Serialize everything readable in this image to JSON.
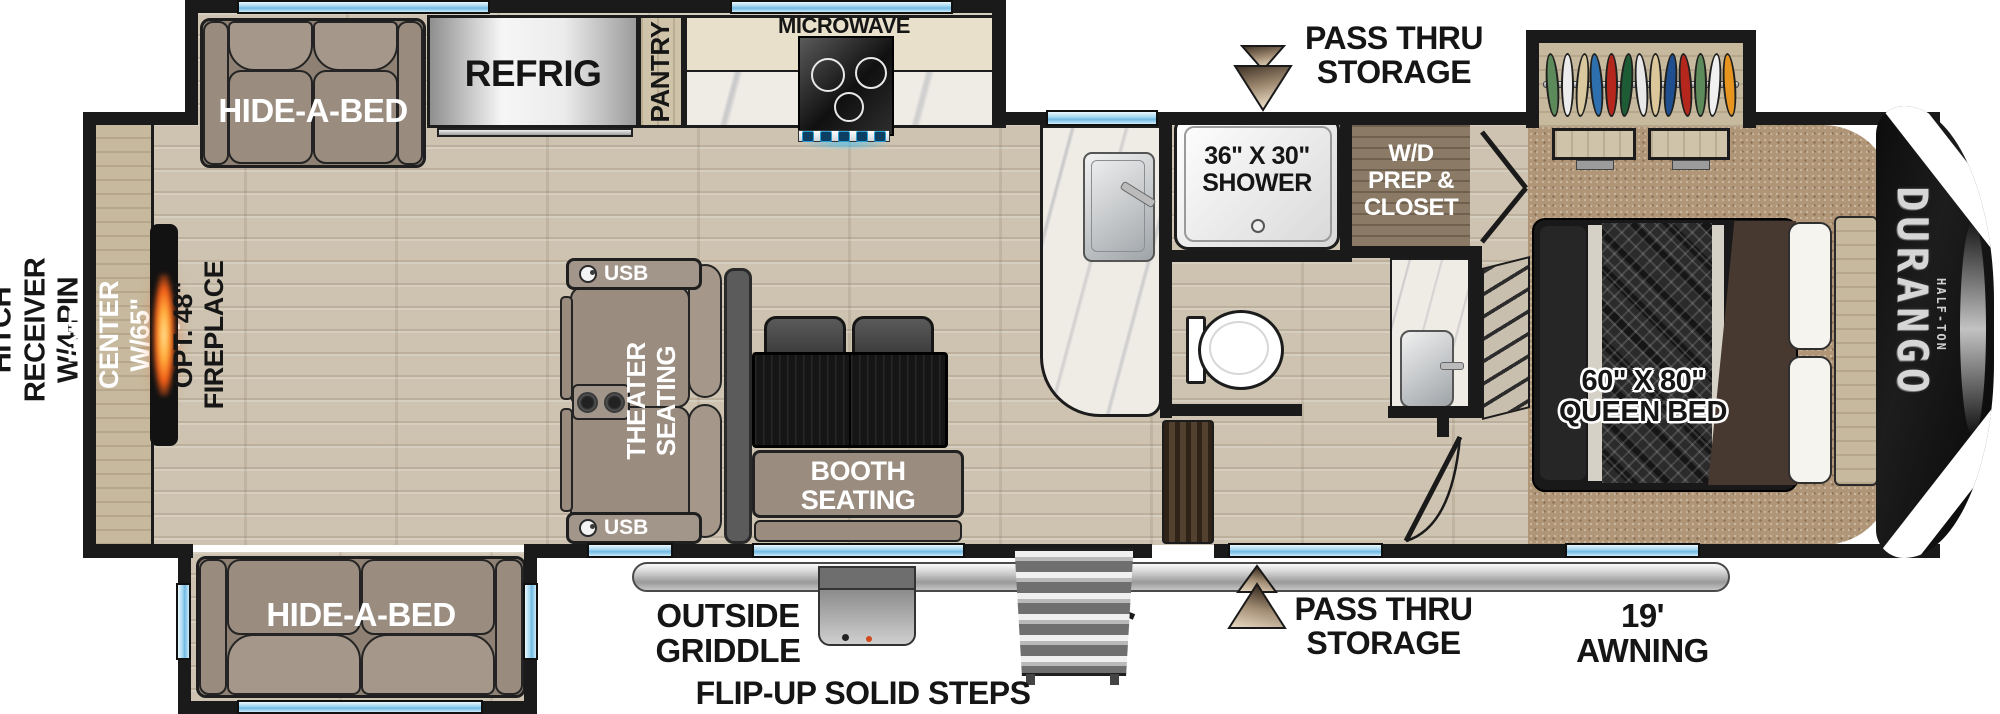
{
  "exterior": {
    "hitch_label": "STD. HITCH RECEIVER\nW/4-PIN HARNESS",
    "pass_thru_top": "PASS THRU\nSTORAGE",
    "pass_thru_bottom": "PASS THRU\nSTORAGE",
    "outside_griddle": "OUTSIDE\nGRIDDLE",
    "flip_up_steps": "FLIP-UP SOLID STEPS",
    "awning": "19'\nAWNING"
  },
  "living_area": {
    "ent_center": "ENT. CENTER W/65\" TV",
    "fireplace": "OPT. 48\" FIREPLACE",
    "hide_a_bed_top": "HIDE-A-BED",
    "hide_a_bed_bottom": "HIDE-A-BED",
    "theater_seating": "THEATER SEATING",
    "usb_top": "USB",
    "usb_bottom": "USB",
    "booth_seating": "BOOTH\nSEATING"
  },
  "kitchen": {
    "refrigerator": "REFRIG",
    "pantry": "PANTRY",
    "microwave": "MICROWAVE"
  },
  "bathroom": {
    "shower": "36\" X 30\"\nSHOWER",
    "wd_prep_closet": "W/D\nPREP &\nCLOSET"
  },
  "bedroom": {
    "queen_bed": "60\" X 80\"\nQUEEN BED",
    "closet_clothes_colors": [
      "#5d8a5a",
      "#ececec",
      "#d9c89e",
      "#2e6fae",
      "#b5271c",
      "#1e5c35",
      "#e8e8e8",
      "#dcc79b",
      "#1f4f8f",
      "#b5271c",
      "#5d8a5a",
      "#f0f0f0",
      "#e89520"
    ]
  },
  "brand": {
    "name": "DURANGO",
    "model": "HALF-TON"
  },
  "colors": {
    "wall": "#1a1a1a",
    "window_blue": "#9fd4ef",
    "wood_floor": "#cdc3b0",
    "carpet": "#b09677",
    "upholstery": "#9a8d80",
    "fireplace_glow": "#ff8c1f",
    "arrow_bronze": "#a08b72",
    "accent_black": "#111111"
  }
}
